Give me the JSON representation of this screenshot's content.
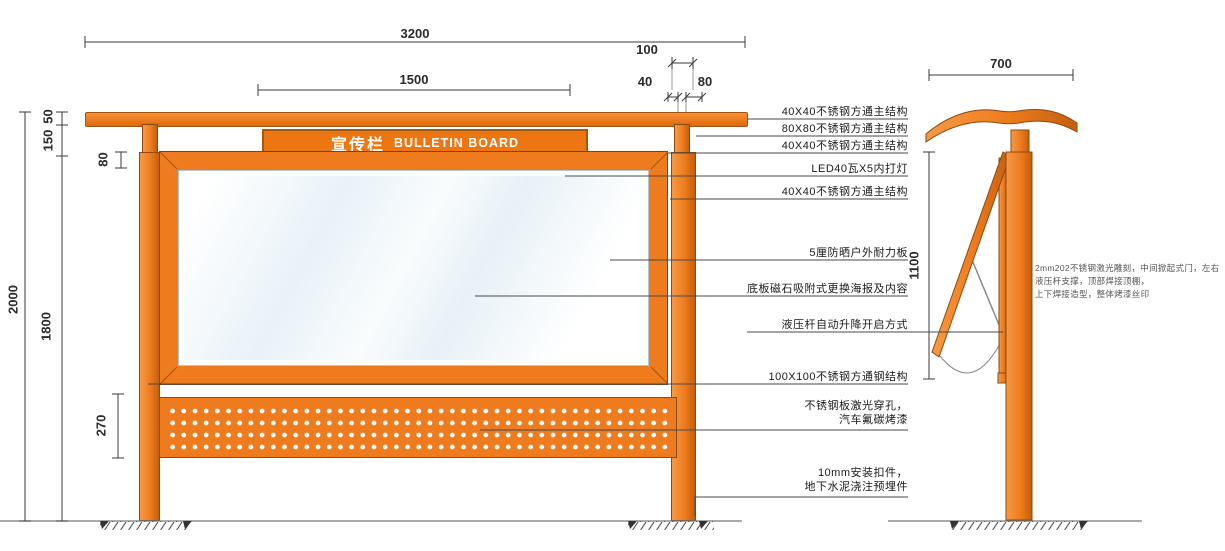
{
  "title": {
    "zh": "宣传栏",
    "en": "BULLETIN BOARD"
  },
  "dims": {
    "w3200": "3200",
    "w1500": "1500",
    "d100": "100",
    "d40": "40",
    "d80t": "80",
    "h2000": "2000",
    "h1800": "1800",
    "d50": "50",
    "d150": "150",
    "d80l": "80",
    "d270": "270",
    "w700": "700",
    "h1100": "1100"
  },
  "annotations": [
    {
      "text": "40X40不锈钢方通主结构"
    },
    {
      "text": "80X80不锈钢方通主结构"
    },
    {
      "text": "40X40不锈钢方通主结构"
    },
    {
      "text": "LED40瓦X5内打灯"
    },
    {
      "text": "40X40不锈钢方通主结构"
    },
    {
      "text": "5厘防晒户外耐力板"
    },
    {
      "text": "底板磁石吸附式更换海报及内容"
    },
    {
      "text": "液压杆自动升降开启方式"
    },
    {
      "text": "100X100不锈钢方通钢结构"
    },
    {
      "line1": "不锈钢板激光穿孔，",
      "line2": "汽车氟碳烤漆"
    },
    {
      "line1": "10mm安装扣件，",
      "line2": "地下水泥浇注预埋件"
    }
  ],
  "side_note": {
    "line1": "2mm202不锈钢激光雕刻，中间掀起式门，左右",
    "line2": "液压杆支撑，顶部焊接顶棚，",
    "line3": "上下焊接造型，整体烤漆丝印"
  },
  "colors": {
    "orange": "#ee7b1d",
    "orange_dark": "#c35f0d",
    "outline": "#8a4a10",
    "line": "#4a4a4a",
    "glass": "#e8f2f8"
  }
}
